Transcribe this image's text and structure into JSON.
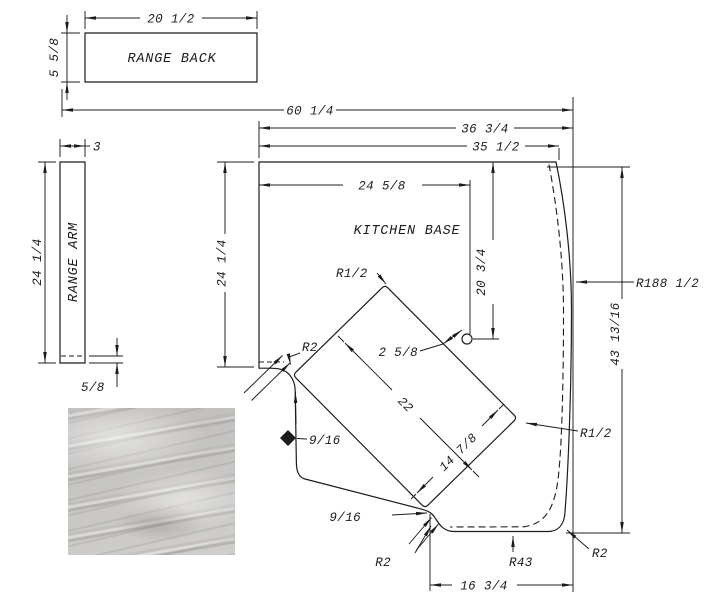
{
  "drawing": {
    "parts": {
      "range_back": {
        "label": "RANGE BACK"
      },
      "range_arm": {
        "label": "RANGE ARM"
      },
      "kitchen_base": {
        "label": "KITCHEN BASE"
      }
    },
    "dims": {
      "back_width": "20 1/2",
      "back_height": "5 5/8",
      "arm_width": "3",
      "arm_length": "24 1/4",
      "arm_edge": "5/8",
      "overall_width": "60 1/4",
      "base_outer_width": "36 3/4",
      "base_top_width": "35 1/2",
      "hole_from_left": "24 5/8",
      "hole_from_top": "20 3/4",
      "base_left_height": "24 1/4",
      "base_right_height": "43 13/16",
      "base_bottom_width": "16 3/4",
      "cutout_length": "22",
      "cutout_width": "14 7/8",
      "hole_to_cutout": "2 5/8",
      "strip_top": "9/16",
      "strip_bottom": "9/16"
    },
    "radii": {
      "arm_corner": "R2",
      "cutout_top": "R1/2",
      "cutout_right": "R1/2",
      "bottom_left": "R2",
      "bottom_sweep": "R43",
      "bottom_right": "R2",
      "right_edge": "R188 1/2"
    },
    "colors": {
      "line": "#1c1c1c",
      "background": "#ffffff"
    }
  }
}
